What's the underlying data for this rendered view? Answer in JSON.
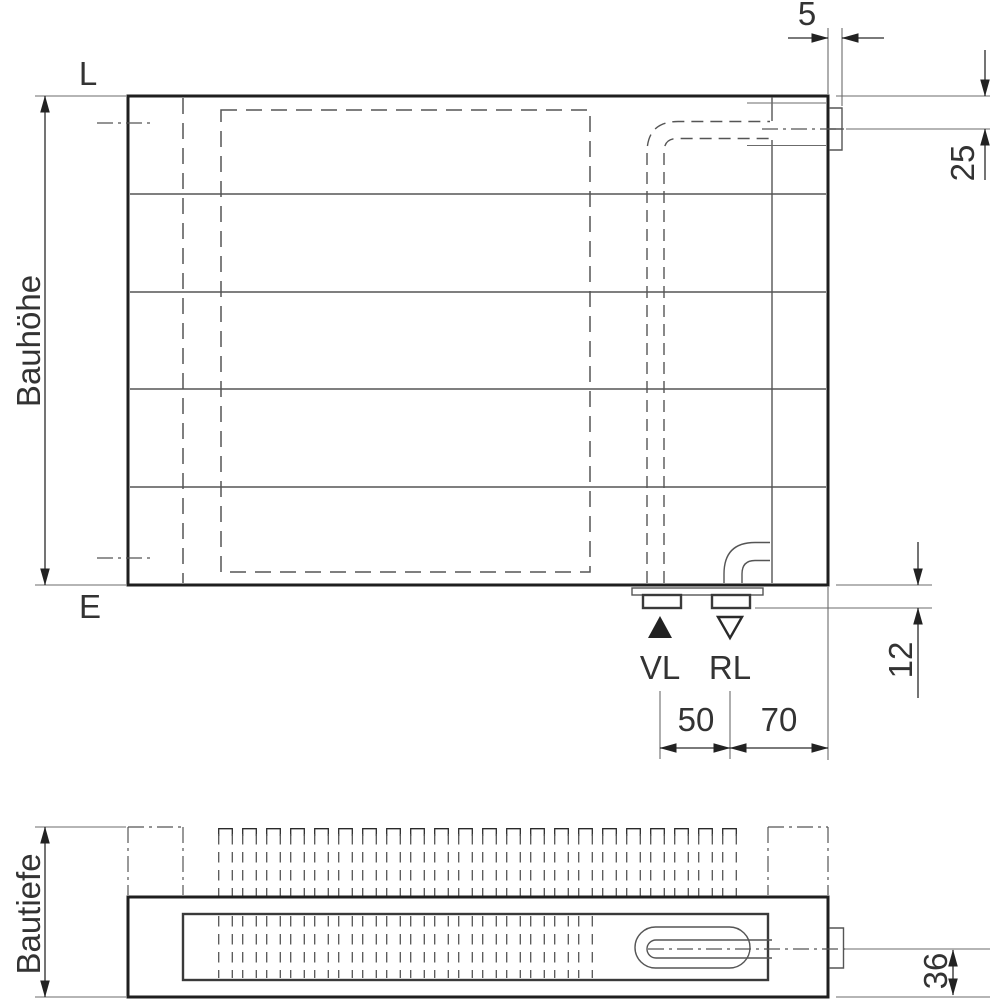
{
  "drawing": {
    "front_view": {
      "corner_label_top": "L",
      "corner_label_bottom": "E",
      "height_dim_label": "Bauhöhe",
      "supply_label": "VL",
      "return_label": "RL",
      "dim_bracket_width": "5",
      "dim_top_to_connection": "25",
      "dim_stub_protrusion": "12",
      "dim_supply_return": "50",
      "dim_return_to_edge": "70"
    },
    "top_view": {
      "depth_dim_label": "Bautiefe",
      "dim_center_to_bottom": "36"
    }
  }
}
